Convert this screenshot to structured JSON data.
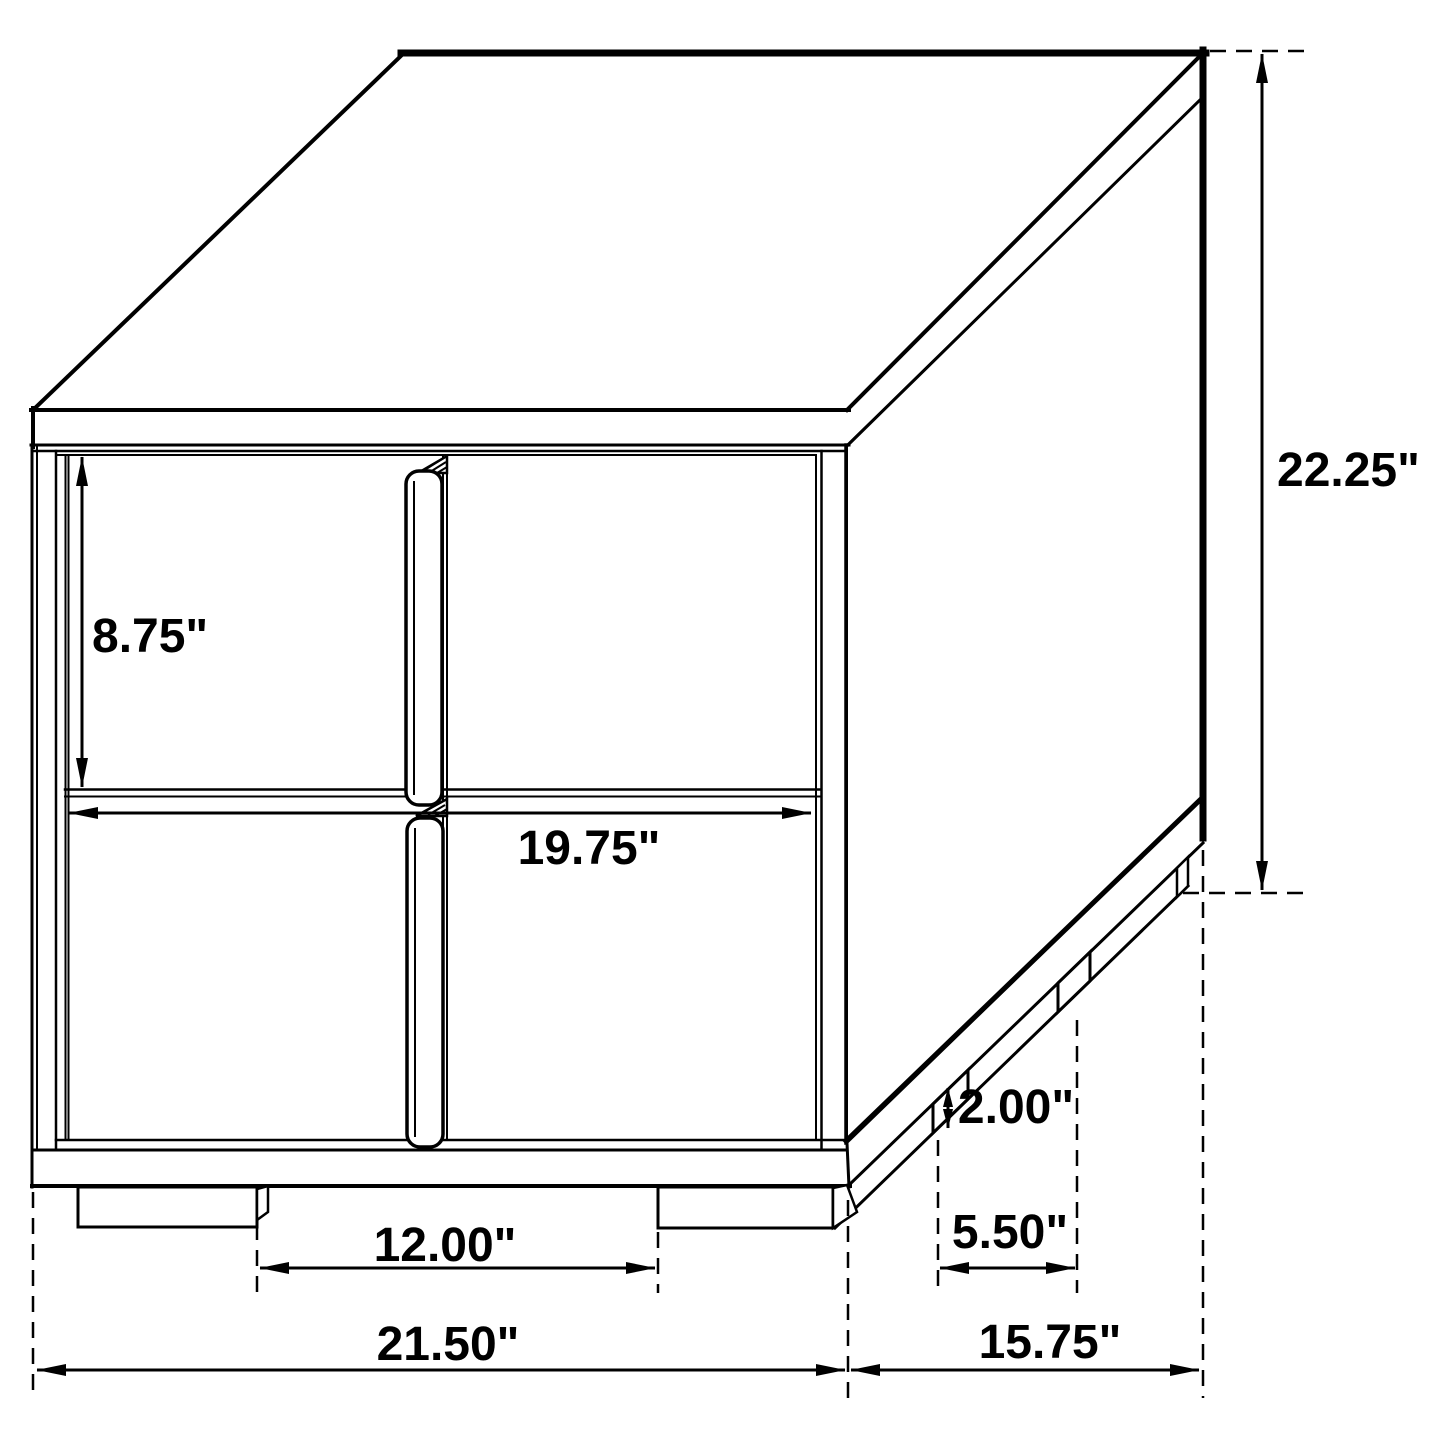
{
  "figure": {
    "type": "dimension-diagram",
    "subject": "two-drawer nightstand",
    "view": "isometric line drawing",
    "units": "inches",
    "background_color": "#ffffff",
    "line_color": "#000000",
    "dimensions": [
      {
        "id": "drawer-front-height",
        "label": "8.75\"",
        "value": 8.75
      },
      {
        "id": "drawer-front-width",
        "label": "19.75\"",
        "value": 19.75
      },
      {
        "id": "overall-height",
        "label": "22.25\"",
        "value": 22.25
      },
      {
        "id": "leg-height",
        "label": "2.00\"",
        "value": 2.0
      },
      {
        "id": "side-leg-spacing",
        "label": "5.50\"",
        "value": 5.5
      },
      {
        "id": "front-leg-spacing",
        "label": "12.00\"",
        "value": 12.0
      },
      {
        "id": "overall-width",
        "label": "21.50\"",
        "value": 21.5
      },
      {
        "id": "overall-depth",
        "label": "15.75\"",
        "value": 15.75
      }
    ]
  }
}
